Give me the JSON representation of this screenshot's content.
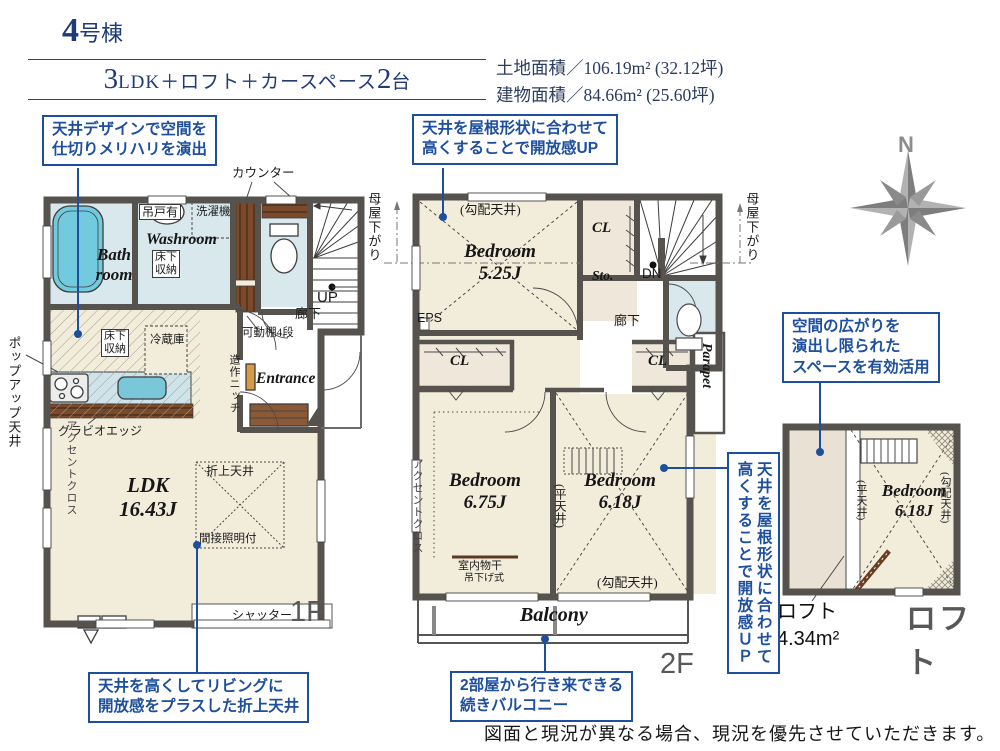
{
  "header": {
    "building_no": "4",
    "building_suffix": "号棟",
    "plan_big1": "3",
    "plan_mid": "LDK＋ロフト＋カースペース",
    "plan_big2": "2",
    "plan_suffix": "台",
    "land_area": "土地面積／106.19m² (32.12坪)",
    "building_area": "建物面積／84.66m² (25.60坪)"
  },
  "compass": {
    "north": "N"
  },
  "callouts": {
    "c1": "天井デザインで空間を\n仕切りメリハリを演出",
    "c2": "天井を屋根形状に合わせて\n高くすることで開放感UP",
    "c3": "空間の広がりを\n演出し限られた\nスペースを有効活用",
    "c4": "天井を屋根形状に合わせて\n高くすることで開放感ＵＰ",
    "c5": "天井を高くしてリビングに\n開放感をプラスした折上天井",
    "c6": "2部屋から行き来できる\n続きバルコニー"
  },
  "f1": {
    "floor": "1F",
    "counter": "カウンター",
    "bath": "Bath\nroom",
    "washroom": "Washroom",
    "hanging_cabinet": "吊戸有",
    "washer": "洗濯機",
    "underfloor_wash": "床下\n収納",
    "underfloor_kitchen": "床下\n収納",
    "fridge": "冷蔵庫",
    "up": "UP",
    "hallway": "廊下",
    "shelf": "可動棚4段",
    "niche": "造作ニッチ",
    "entrance": "Entrance",
    "gravio": "グラビオエッジ",
    "popup": "ポップアップ天井",
    "accent": "アクセントクロス",
    "ldk": "LDK\n16.43J",
    "oriage": "折上天井",
    "indirect": "間接照明付",
    "shutter": "シャッター"
  },
  "f2": {
    "floor": "2F",
    "moya_left": "母屋下がり",
    "moya_right": "母屋下がり",
    "sloped_top": "(勾配天井)",
    "bedroom1": "Bedroom\n5.25J",
    "cl_top": "CL",
    "sto": "Sto.",
    "dn": "DN",
    "hallway": "廊下",
    "eps": "EPS",
    "cl_left": "CL",
    "cl_right": "CL",
    "parapet": "Parapet",
    "accent": "アクセントクロス",
    "bedroom2": "Bedroom\n6.75J",
    "bedroom3": "Bedroom\n6.18J",
    "flat": "(平天井)",
    "sloped_bottom": "(勾配天井)",
    "drying": "室内物干",
    "drying_sub": "吊下げ式",
    "balcony": "Balcony"
  },
  "loft": {
    "title": "ロフト",
    "bedroom": "Bedroom\n6.18J",
    "flat": "(平天井)",
    "sloped": "(勾配天井)",
    "area": "ロフト\n4.34m²"
  },
  "footer": "図面と現況が異なる場合、現況を優先させていただきます。"
}
